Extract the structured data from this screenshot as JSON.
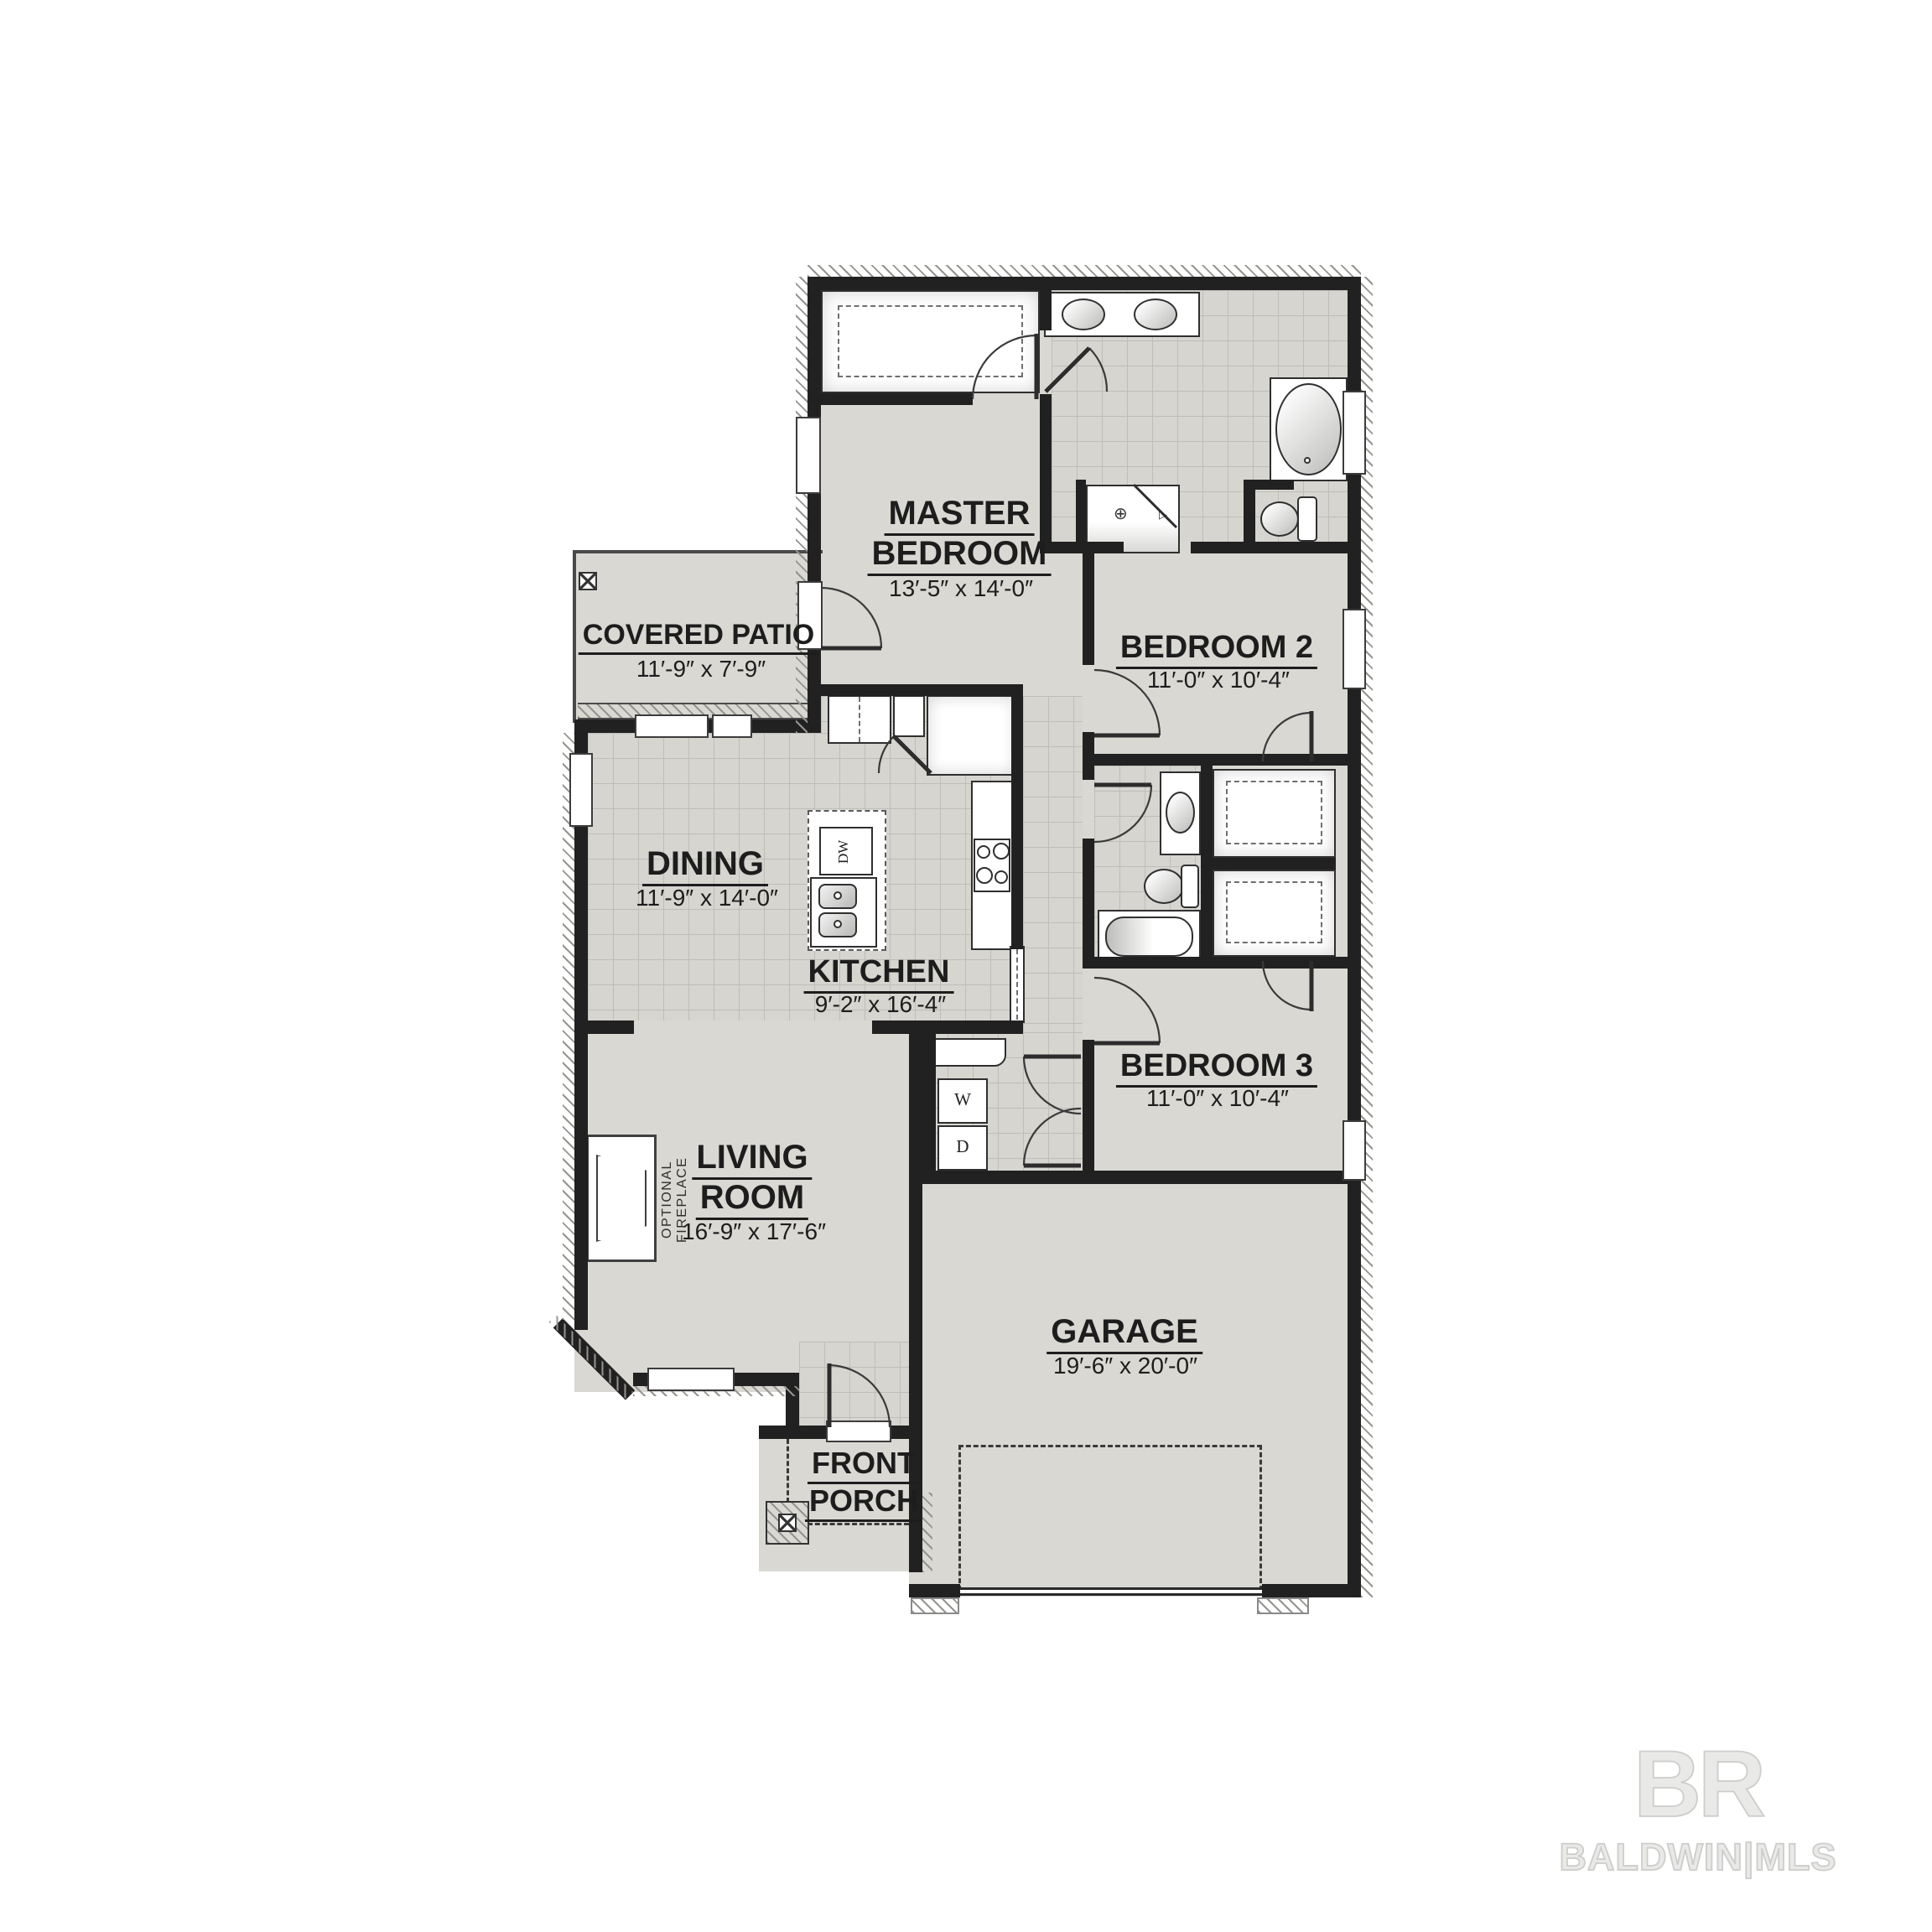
{
  "plan": {
    "rooms": {
      "covered_patio": {
        "name": "COVERED PATIO",
        "dims": "11′-9″ x 7′-9″"
      },
      "master_bedroom": {
        "line1": "MASTER",
        "line2": "BEDROOM",
        "dims": "13′-5″ x 14′-0″"
      },
      "bedroom_2": {
        "name": "BEDROOM 2",
        "dims": "11′-0″ x 10′-4″"
      },
      "dining": {
        "name": "DINING",
        "dims": "11′-9″ x 14′-0″"
      },
      "kitchen": {
        "name": "KITCHEN",
        "dims": "9′-2″ x 16′-4″"
      },
      "bedroom_3": {
        "name": "BEDROOM 3",
        "dims": "11′-0″ x 10′-4″"
      },
      "living_room": {
        "line1": "LIVING",
        "line2": "ROOM",
        "dims": "16′-9″ x 17′-6″"
      },
      "garage": {
        "name": "GARAGE",
        "dims": "19′-6″ x 20′-0″"
      },
      "front_porch": {
        "line1": "FRONT",
        "line2": "PORCH"
      }
    },
    "appliances": {
      "washer": "W",
      "dryer": "D",
      "dishwasher": "DW"
    },
    "notes": {
      "optional_fireplace": "OPTIONAL FIREPLACE"
    },
    "symbols": {
      "shower_head": "⊕",
      "shower_valve": "▷"
    }
  },
  "watermark": {
    "logo": "BR",
    "caption": "BALDWIN|MLS"
  },
  "colors": {
    "background": "#ffffff",
    "wall": "#212121",
    "floor": "#d9d8d3",
    "tile": "#d6d5d0",
    "tile_grid": "#bebdb8",
    "fixture_outline": "#2f2f2f",
    "label": "#1d1d1d",
    "watermark": "#cdcdcb"
  }
}
